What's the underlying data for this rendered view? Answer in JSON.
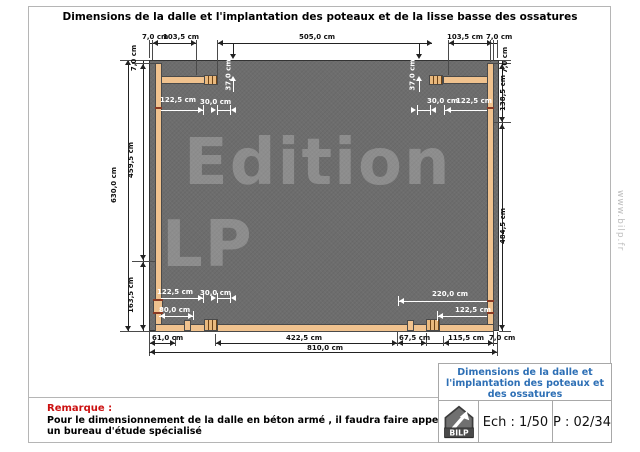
{
  "header": {
    "title": "Dimensions de la dalle et l'implantation des poteaux et de la lisse basse des ossatures"
  },
  "watermark": {
    "line1": "Edition",
    "line2": "LP",
    "site": "www.bilp.fr"
  },
  "dims": {
    "d7_0": "7,0 cm",
    "d30_0": "30,0 cm",
    "d37_0": "37,0 cm",
    "d61_0": "61,0 cm",
    "d67_5": "67,5 cm",
    "d80_0": "80,0 cm",
    "d103_5": "103,5 cm",
    "d115_5": "115,5 cm",
    "d122_5": "122,5 cm",
    "d138_5": "138,5 cm",
    "d163_5": "163,5 cm",
    "d220_0": "220,0 cm",
    "d422_5": "422,5 cm",
    "d459_5": "459,5 cm",
    "d484_5": "484,5 cm",
    "d505_0": "505,0 cm",
    "d630_0": "630,0 cm",
    "d810_0": "810,0 cm"
  },
  "remark": {
    "label": "Remarque :",
    "text": "Pour le dimensionnement de la dalle en béton armé , il faudra faire appel à un bureau d'étude spécialisé"
  },
  "title_block": {
    "title": "Dimensions de la dalle et l'implantation des poteaux et des ossatures",
    "logo": "BILP",
    "scale": "Ech : 1/50",
    "page": "P : 02/34"
  },
  "colors": {
    "slab_gray": "#6d6d6d",
    "beam_tan": "#f0c28e",
    "beam_stripe_brown": "#6d4317",
    "accent_blue": "#2d6fb5",
    "remark_red": "#cc1111"
  }
}
